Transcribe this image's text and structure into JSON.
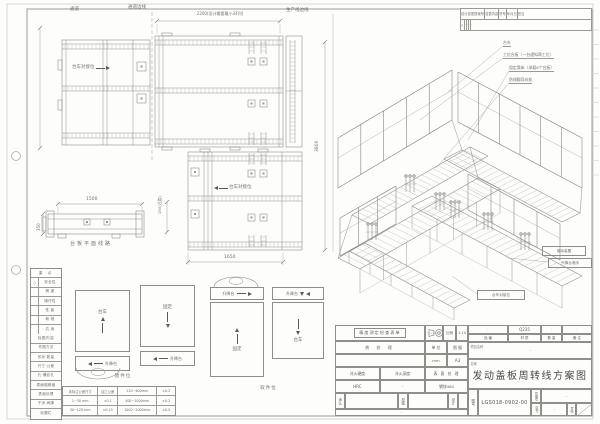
{
  "revision_table": {
    "headers": [
      "设计变更提案号",
      "变更内容",
      "符号",
      "年月日",
      "担当"
    ],
    "row": [
      "△",
      "·",
      "·",
      "·",
      "·"
    ]
  },
  "plan": {
    "aisle_label": "通道",
    "aisle_edge_label": "通道边线",
    "line_edge_label": "生产线边线",
    "dim_2200": "2200(设计需要最小34列)",
    "dock_label": "台车对接位",
    "dim_1500": "1500",
    "dim_350": "350",
    "dim_150": "150(过渡)",
    "dim_1650": "1650",
    "dim_3800": "3800",
    "platform_view_label": "台板平面线路"
  },
  "iso": {
    "callouts": [
      "台车",
      "工位台板（一台虚拟两工位）",
      "固定滑床（承载6个台板）",
      "防倾翻导向轨"
    ],
    "boxed_callouts": [
      "驱动装置",
      "升降台滚床",
      "台车对接位"
    ]
  },
  "stations": {
    "trolley": "台车",
    "fixed": "固定",
    "lift": "升降台",
    "load_label": "放件位",
    "pick_label": "取件位"
  },
  "checklist": {
    "header": "重 点",
    "items": [
      {
        "mark": "○",
        "label": "安全性"
      },
      {
        "mark": "",
        "label": "精 度"
      },
      {
        "mark": "",
        "label": "操作性"
      },
      {
        "mark": "",
        "label": "性 能"
      },
      {
        "mark": "",
        "label": "新 规"
      },
      {
        "mark": "",
        "label": "共 用"
      }
    ],
    "section2": "检图内容",
    "items2": [
      "作图方法",
      "形状·数量",
      "尺寸·公差",
      "孔·螺纹孔",
      "表面粗糙度",
      "表面处理",
      "干涉·间隙",
      "标题栏"
    ]
  },
  "tolerance_table": {
    "rows": [
      [
        "未标注公差尺寸",
        "加工公差",
        "120~400mm",
        "±0.2"
      ],
      [
        "1~30 mm",
        "±0.1",
        "400~1000mm",
        "±0.3"
      ],
      [
        "30~120 mm",
        "±0.15",
        "1000~2000mm",
        "±0.5"
      ]
    ]
  },
  "title_block": {
    "check_box": "精度测定检查表单",
    "scale_label": "比例",
    "scale_value": "1:10",
    "heat_label": "热 处 理",
    "unit_label": "单 位",
    "unit_value": "mm",
    "size_label": "图 幅",
    "size_value": "A3",
    "hardness_label": "淬火硬度",
    "hardness_value": "HRC",
    "depth_label": "淬火深度",
    "depth_value": "·",
    "surface_label": "表 面 处 理",
    "surface_value": "镀锌480",
    "approve_label": "承认",
    "check_label": "校图",
    "design_label": "设计",
    "sig_note": "·",
    "part_no_label": "品 番",
    "part_no_value": "·",
    "material_label": "材 质",
    "material_value": "Q235",
    "qty_label": "数 量",
    "qty_value": "·",
    "remark_label": "备 注",
    "remark_value": "·",
    "project_label": "项目名称",
    "project_value": "·",
    "name_label": "名称",
    "drawing_title": "发动盖板周转线方案图",
    "dwg_no_label": "图号",
    "dwg_no": "LGS018-0902-00",
    "mgmt_label": "管理号",
    "mgmt_value": "·",
    "class_label": "区分",
    "class_value": "·",
    "page_label": "页码"
  }
}
